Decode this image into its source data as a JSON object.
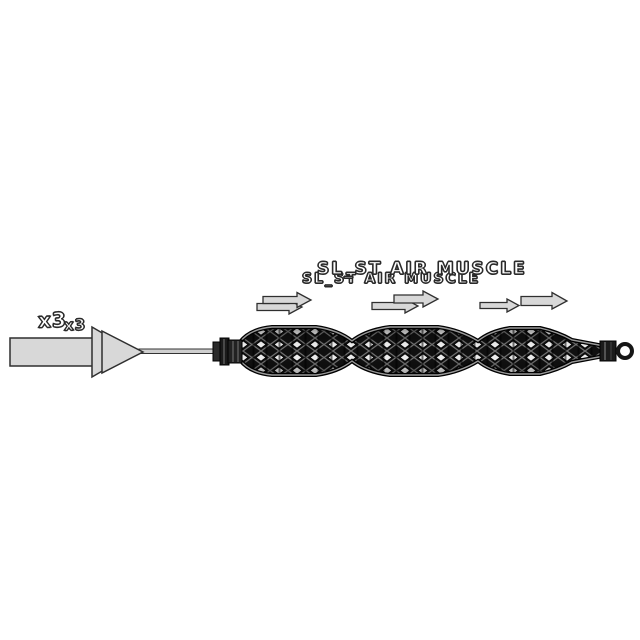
{
  "scene": {
    "background_color": "#ffffff",
    "title": {
      "front": "SL_ST AIR MUSCLE",
      "back": "SL_ST AIR MUSCLE"
    },
    "multiplier": {
      "front": "x3",
      "back": "x3"
    },
    "colors": {
      "arrow_fill": "#d8d8d8",
      "arrow_outline": "#2f2f2f",
      "rod_fill": "#cfcfcf",
      "text_fill": "#ffffff",
      "text_outline": "#2a2a2a",
      "muscle_body": "#101010",
      "muscle_rim": "#9a9a9a",
      "mesh_line": "#6f6f6f",
      "mesh_highlight": "#e9e9e9",
      "fitting_fill": "#1b1b1b",
      "eyelet_fill": "#ffffff",
      "eyelet_ring": "#161616"
    }
  }
}
